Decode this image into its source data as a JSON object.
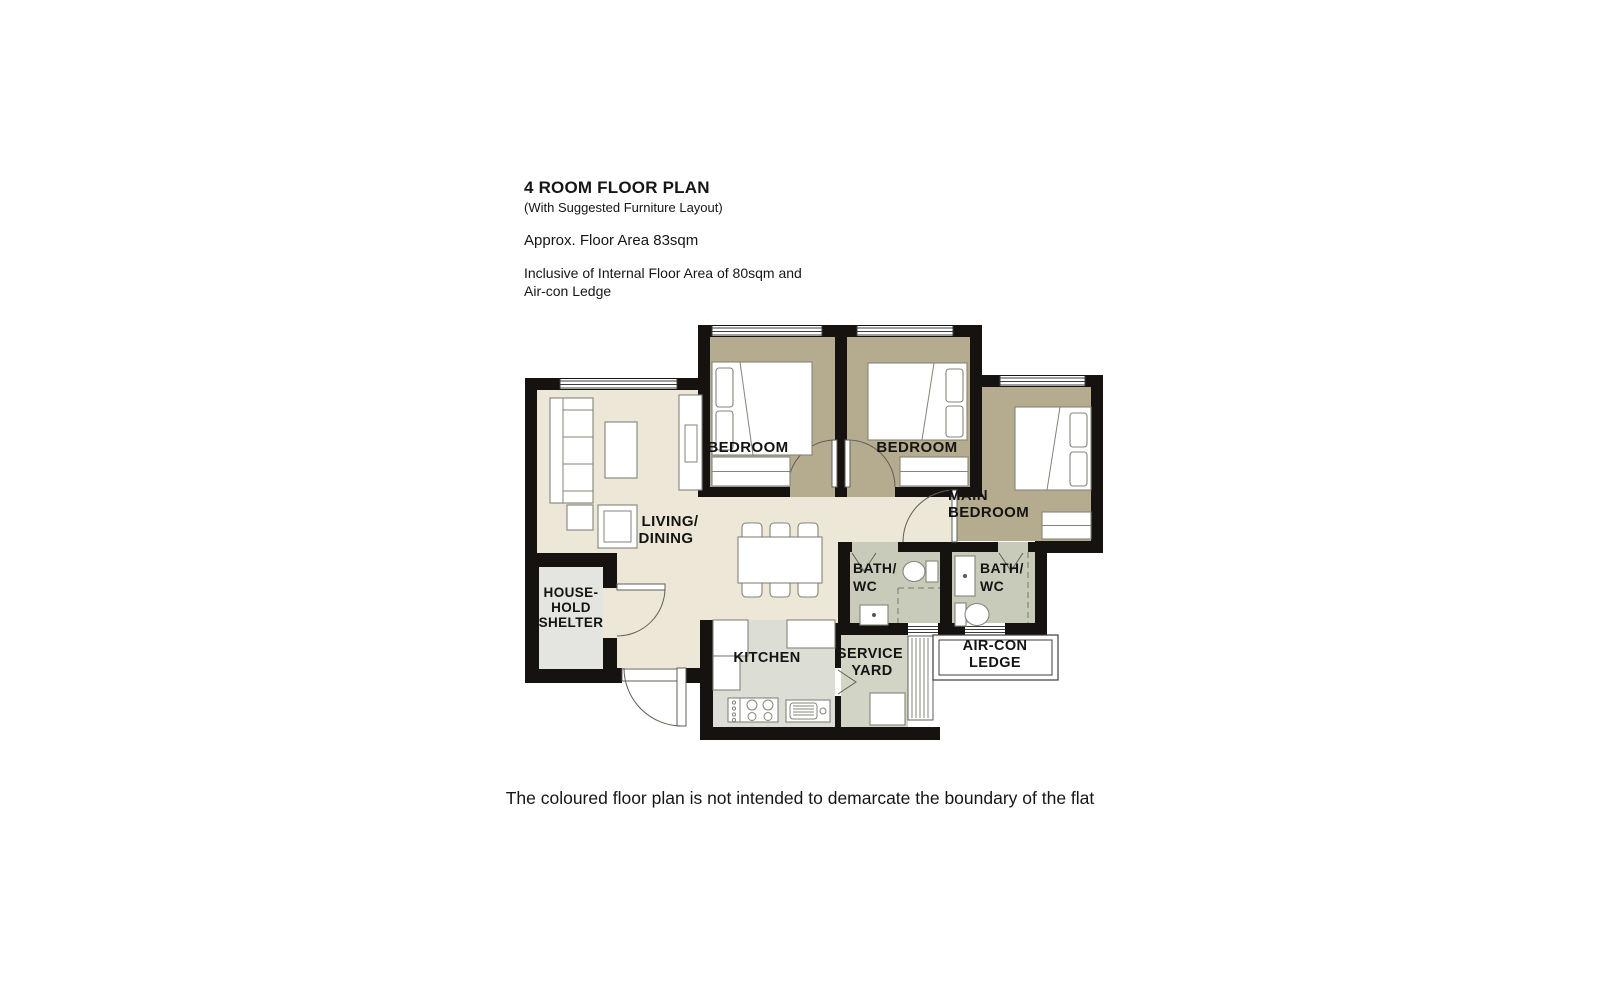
{
  "header": {
    "title": "4 ROOM FLOOR PLAN",
    "subtitle": "(With Suggested Furniture Layout)",
    "area": "Approx. Floor Area 83sqm",
    "inclusive_line1": "Inclusive of Internal Floor Area of 80sqm and",
    "inclusive_line2": "Air-con Ledge"
  },
  "footer": {
    "disclaimer": "The coloured floor plan is not intended to demarcate the boundary of the flat"
  },
  "rooms": {
    "living_line1": "LIVING/",
    "living_line2": "DINING",
    "bedroom1": "BEDROOM",
    "bedroom2": "BEDROOM",
    "main_line1": "MAIN",
    "main_line2": "BEDROOM",
    "bath1_line1": "BATH/",
    "bath1_line2": "WC",
    "bath2_line1": "BATH/",
    "bath2_line2": "WC",
    "kitchen": "KITCHEN",
    "service_line1": "SERVICE",
    "service_line2": "YARD",
    "aircon_line1": "AIR-CON",
    "aircon_line2": "LEDGE",
    "shelter_line1": "HOUSE-",
    "shelter_line2": "HOLD",
    "shelter_line3": "SHELTER"
  },
  "colors": {
    "wall": "#151210",
    "floor-living": "#ece7d7",
    "floor-bedroom": "#b5ac90",
    "floor-bath": "#c9cbba",
    "floor-kitchen": "#dcddd5",
    "floor-service": "#d2d4c6",
    "floor-shelter": "#e4e4e0",
    "ink": "#161616"
  }
}
